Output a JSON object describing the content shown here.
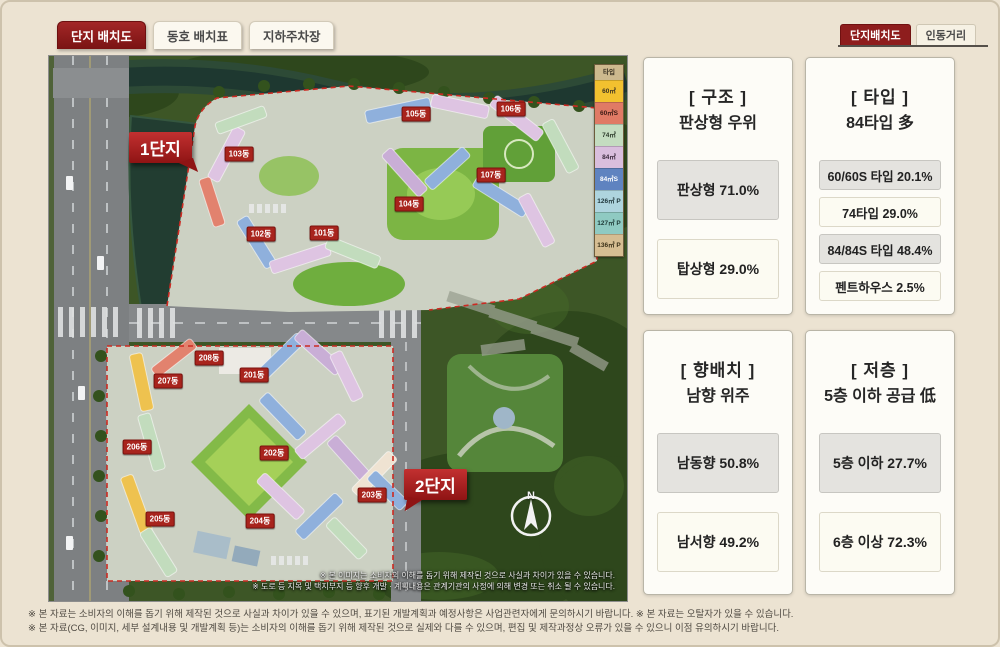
{
  "tabs": [
    {
      "label": "단지 배치도",
      "active": true
    },
    {
      "label": "동호 배치표",
      "active": false
    },
    {
      "label": "지하주차장",
      "active": false
    }
  ],
  "view_tabs": [
    {
      "label": "단지배치도",
      "active": true
    },
    {
      "label": "인동거리",
      "active": false
    }
  ],
  "map": {
    "district1_label": "1단지",
    "district2_label": "2단지",
    "compass_label": "N",
    "legend": {
      "header": "타입",
      "items": [
        {
          "label": "60㎡",
          "color": "#f2c12f",
          "text": "#3a3222"
        },
        {
          "label": "60㎡S",
          "color": "#e07a65",
          "text": "#3a1a14"
        },
        {
          "label": "74㎡",
          "color": "#c4dcc0",
          "text": "#2c3a2a"
        },
        {
          "label": "84㎡",
          "color": "#d9bedd",
          "text": "#3a2a3c"
        },
        {
          "label": "84㎡S",
          "color": "#5f83c0",
          "text": "#ffffff"
        },
        {
          "label": "126㎡ P",
          "color": "#aed4de",
          "text": "#21373c"
        },
        {
          "label": "127㎡ P",
          "color": "#8fcac2",
          "text": "#1e3a36"
        },
        {
          "label": "136㎡ P",
          "color": "#d6bd92",
          "text": "#3a3018"
        }
      ]
    },
    "building_tags": [
      {
        "label": "101동",
        "x": 275,
        "y": 177
      },
      {
        "label": "102동",
        "x": 212,
        "y": 178
      },
      {
        "label": "103동",
        "x": 190,
        "y": 98
      },
      {
        "label": "104동",
        "x": 360,
        "y": 148
      },
      {
        "label": "105동",
        "x": 367,
        "y": 58
      },
      {
        "label": "106동",
        "x": 462,
        "y": 53
      },
      {
        "label": "107동",
        "x": 442,
        "y": 119
      },
      {
        "label": "201동",
        "x": 205,
        "y": 319
      },
      {
        "label": "202동",
        "x": 225,
        "y": 397
      },
      {
        "label": "203동",
        "x": 323,
        "y": 439
      },
      {
        "label": "204동",
        "x": 211,
        "y": 465
      },
      {
        "label": "205동",
        "x": 111,
        "y": 463
      },
      {
        "label": "206동",
        "x": 88,
        "y": 391
      },
      {
        "label": "207동",
        "x": 119,
        "y": 325
      },
      {
        "label": "208동",
        "x": 160,
        "y": 302
      }
    ],
    "caption_line1": "※ 본 이미지는 소비자의 이해를 돕기 위해 제작된 것으로 사실과 차이가 있을 수 있습니다.",
    "caption_line2": "※ 도로 등 지목 및 택지부지 등 향후 개발 · 계획내용은 관계기관의 사정에 의해 변경 또는 취소 될 수 있습니다."
  },
  "panels": [
    {
      "title": "[ 구조 ]",
      "subtitle": "판상형 우위",
      "stats": [
        {
          "label": "판상형 71.0%",
          "highlight": true
        },
        {
          "label": "탑상형 29.0%",
          "highlight": false
        }
      ]
    },
    {
      "title": "[ 타입 ]",
      "subtitle": "84타입 多",
      "stats": [
        {
          "label": "60/60S 타입 20.1%",
          "highlight": true
        },
        {
          "label": "74타입 29.0%",
          "highlight": false
        },
        {
          "label": "84/84S 타입 48.4%",
          "highlight": true
        },
        {
          "label": "펜트하우스 2.5%",
          "highlight": false
        }
      ]
    },
    {
      "title": "[ 향배치 ]",
      "subtitle": "남향 위주",
      "stats": [
        {
          "label": "남동향 50.8%",
          "highlight": true
        },
        {
          "label": "남서향 49.2%",
          "highlight": false
        }
      ]
    },
    {
      "title": "[ 저층 ]",
      "subtitle": "5층 이하 공급 低",
      "stats": [
        {
          "label": "5층 이하 27.7%",
          "highlight": true
        },
        {
          "label": "6층 이상 72.3%",
          "highlight": false
        }
      ]
    }
  ],
  "footnotes": [
    "※ 본 자료는 소비자의 이해를 돕기 위해 제작된 것으로 사실과 차이가 있을 수 있으며, 표기된 개발계획과 예정사항은 사업관련자에게 문의하시기 바랍니다.  ※ 본 자료는 오탈자가 있을 수 있습니다.",
    "※ 본 자료(CG, 이미지, 세부 설계내용 및 개발계획 등)는 소비자의 이해를 돕기 위해 제작된 것으로 실제와 다를 수 있으며, 편집 및 제작과정상 오류가 있을 수 있으니 이점 유의하시기 바랍니다."
  ]
}
